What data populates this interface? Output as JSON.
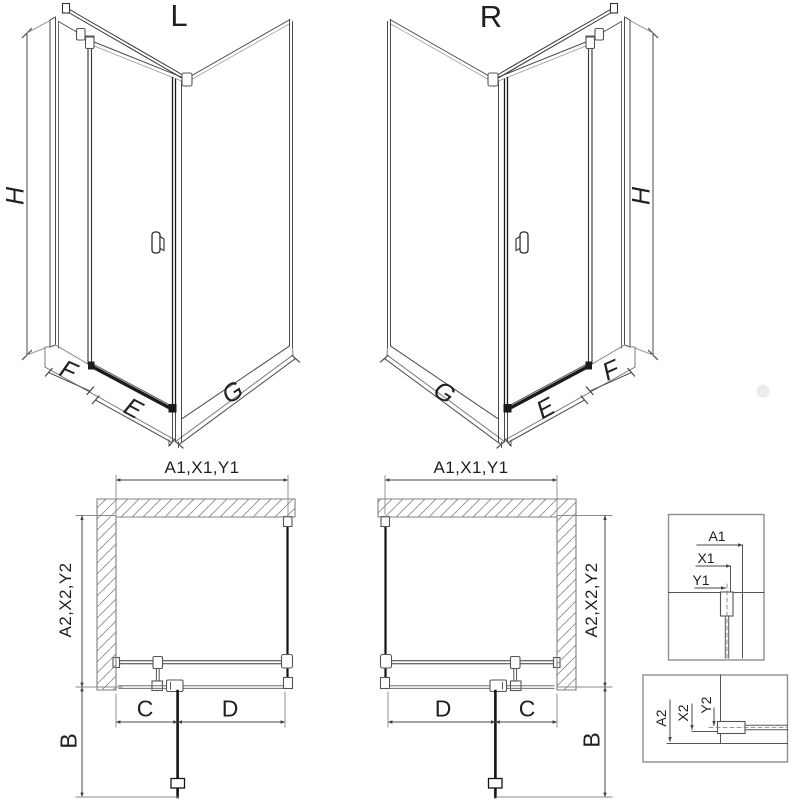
{
  "drawing": {
    "views3d": {
      "left": {
        "title": "L",
        "height": "H",
        "inline_panel": "F",
        "door_width": "E",
        "side_panel": "G"
      },
      "right": {
        "title": "R",
        "height": "H",
        "inline_panel": "F",
        "door_width": "E",
        "side_panel": "G"
      }
    },
    "plans": {
      "left": {
        "width_dim": "A1,X1,Y1",
        "depth_dim": "A2,X2,Y2",
        "door_swing": "B",
        "fixed_segment": "C",
        "door_segment": "D"
      },
      "right": {
        "width_dim": "A1,X1,Y1",
        "depth_dim": "A2,X2,Y2",
        "door_swing": "B",
        "fixed_segment": "C",
        "door_segment": "D"
      }
    },
    "details": {
      "width_box": {
        "a1": "A1",
        "x1": "X1",
        "y1": "Y1"
      },
      "depth_box": {
        "a2": "A2",
        "x2": "X2",
        "y2": "Y2"
      }
    },
    "colors": {
      "line_dark": "#1d1d1d",
      "line_mid": "#4a4a4a",
      "line_gray": "#808080",
      "hatch_gray": "#8c8c8c",
      "box_border": "#8f8f8f"
    }
  }
}
